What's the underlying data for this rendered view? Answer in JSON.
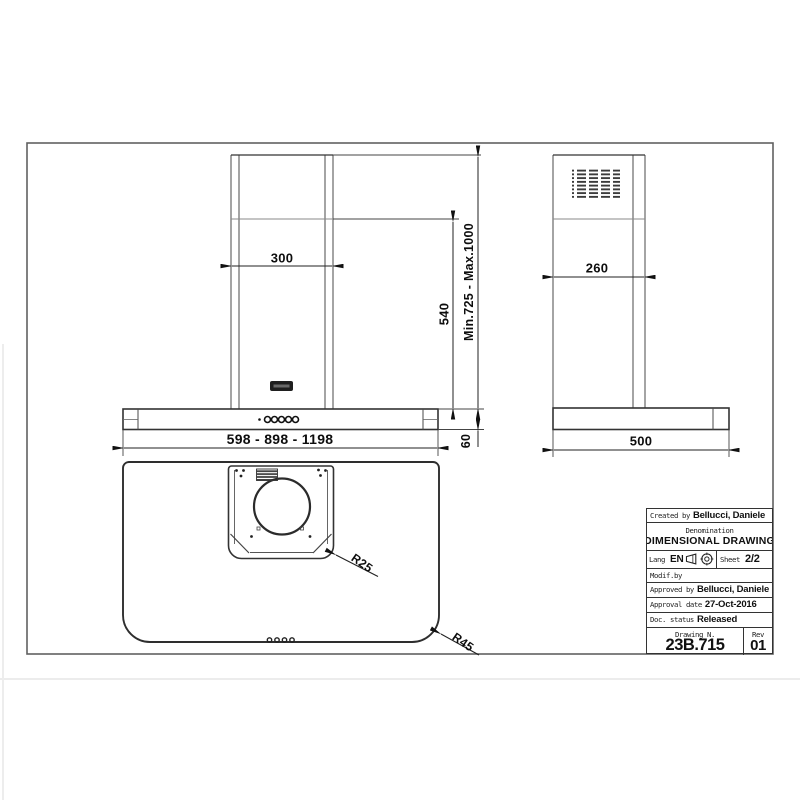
{
  "drawing": {
    "front": {
      "chimney_width": "300",
      "chimney_visible_height": "540",
      "height_range": "Min.725 - Max.1000",
      "body_widths": "598 - 898 - 1198",
      "body_height": "60"
    },
    "side": {
      "chimney_depth": "260",
      "body_depth": "500"
    },
    "top": {
      "inner_corner_radius": "R25",
      "outer_corner_radius": "R45"
    }
  },
  "title_block": {
    "created_by_label": "Created by",
    "created_by": "Bellucci, Daniele",
    "denomination_label": "Denomination",
    "denomination": "DIMENSIONAL DRAWING",
    "lang_label": "Lang",
    "lang": "EN",
    "projection_icons": [
      "first-angle-cone-icon",
      "first-angle-target-icon"
    ],
    "sheet_label": "Sheet",
    "sheet": "2/2",
    "modif_by_label": "Modif.by",
    "approved_by_label": "Approved by",
    "approved_by": "Bellucci, Daniele",
    "approval_date_label": "Approval date",
    "approval_date": "27-Oct-2016",
    "doc_status_label": "Doc. status",
    "doc_status": "Released",
    "drawing_n_label": "Drawing N.",
    "drawing_n": "23B.715",
    "rev_label": "Rev",
    "rev": "01"
  },
  "colors": {
    "line": "#333333",
    "dim_text": "#0d0d0d",
    "background": "#ffffff"
  }
}
